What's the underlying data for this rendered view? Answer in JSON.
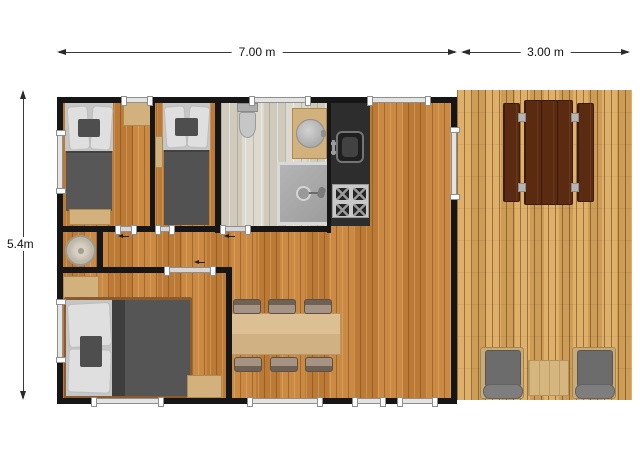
{
  "annotations": {
    "top_width_label": "7.00 m",
    "deck_width_label": "3.00 m",
    "side_height_label": "5.4m"
  },
  "colors": {
    "background": "#ffffff",
    "wall": "#161616",
    "interior_wood_floor": "#c5823c",
    "bathroom_floor": "#dad4c8",
    "deck_wood": "#d9a75f",
    "kitchen_counter": "#2d2d2d",
    "light_furniture_wood": "#d3b17c",
    "picnic_table_wood": "#5a2b10",
    "bed_linen_gray": "#575757",
    "cushion_gray": "#6c6c6c",
    "window_frame": "#e3e3e3"
  },
  "rooms": [
    {
      "name": "twin-bedroom-left",
      "furniture": [
        "single-bed",
        "window-console",
        "foot-bench"
      ]
    },
    {
      "name": "twin-bedroom-right",
      "furniture": [
        "single-bed",
        "side-shelf"
      ]
    },
    {
      "name": "bathroom",
      "furniture": [
        "toilet",
        "vanity-with-round-sink",
        "shower-cabin"
      ]
    },
    {
      "name": "kitchen",
      "furniture": [
        "kitchen-sink",
        "stove-four-burners"
      ]
    },
    {
      "name": "shower-room",
      "furniture": [
        "round-shower"
      ]
    },
    {
      "name": "double-bedroom",
      "furniture": [
        "double-bed",
        "wardrobe",
        "nightstand"
      ]
    },
    {
      "name": "living-dining-room",
      "furniture": [
        "dining-table",
        "six-chairs"
      ]
    },
    {
      "name": "deck-terrace",
      "furniture": [
        "picnic-table",
        "two-benches",
        "two-armchairs",
        "coffee-table"
      ]
    }
  ]
}
